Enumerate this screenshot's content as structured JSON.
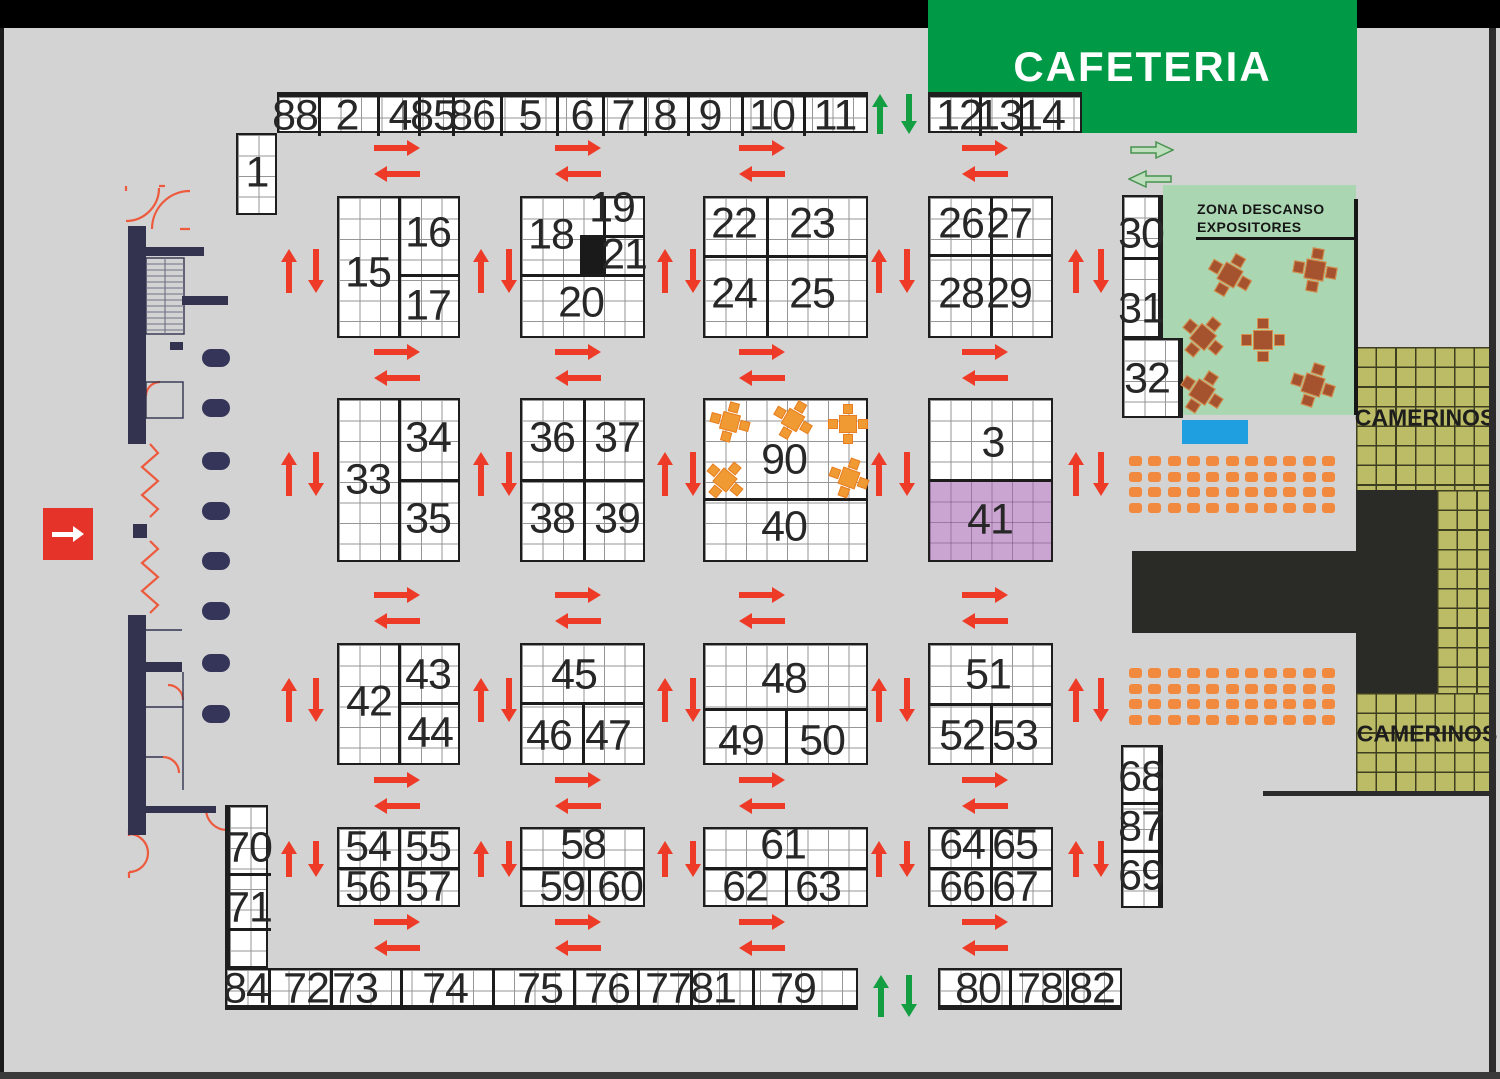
{
  "labels": {
    "cafeteria": "CAFETERIA",
    "zona_line1": "ZONA DESCANSO",
    "zona_line2": "EXPOSITORES",
    "camerinos_top": "CAMERINOS",
    "camerinos_bottom": "CAMERINOS"
  },
  "colors": {
    "background": "#d3d3d3",
    "cafeteria_green": "#009a47",
    "rest_zone_green": "#aad6b1",
    "camerinos_olive": "#bcbb66",
    "booth_white": "#ffffff",
    "grid_line": "#969696",
    "border_black": "#1c1c1c",
    "arrow_red": "#ee3b27",
    "arrow_green": "#149e42",
    "arrow_light_green": "#bedebe",
    "seat_orange": "#f18a3e",
    "table_brown": "#a5532f",
    "table_orange": "#f09a33",
    "booth41_purple": "#cba5d2",
    "stage_black": "#2a2a26",
    "wall_navy": "#33334f",
    "blue_marker": "#1f9fe0",
    "entrance_red": "#e5332a"
  },
  "booth_grids": [
    {
      "name": "strip-top-left",
      "x": 277,
      "y": 92,
      "w": 591,
      "h": 41,
      "thick": "top",
      "vdivs": [
        318,
        377,
        418,
        452,
        500,
        556,
        602,
        644,
        687,
        741,
        803
      ],
      "labels": [
        [
          "88",
          295,
          113
        ],
        [
          "2",
          347,
          113
        ],
        [
          "4",
          400,
          113
        ],
        [
          "85",
          433,
          113
        ],
        [
          "86",
          472,
          113
        ],
        [
          "5",
          530,
          113
        ],
        [
          "6",
          582,
          113
        ],
        [
          "7",
          623,
          113
        ],
        [
          "8",
          665,
          113
        ],
        [
          "9",
          710,
          113
        ],
        [
          "10",
          772,
          113
        ],
        [
          "11",
          835,
          113
        ]
      ]
    },
    {
      "name": "strip-top-right",
      "x": 928,
      "y": 92,
      "w": 154,
      "h": 41,
      "thick": "top",
      "vdivs": [
        979,
        1020
      ],
      "labels": [
        [
          "12",
          959,
          113
        ],
        [
          "13",
          999,
          113
        ],
        [
          "14",
          1042,
          113
        ]
      ]
    },
    {
      "name": "booth-1",
      "x": 236,
      "y": 133,
      "w": 41,
      "h": 82,
      "labels": [
        [
          "1",
          257,
          173
        ]
      ]
    },
    {
      "name": "block-15-16-17",
      "x": 337,
      "y": 196,
      "w": 123,
      "h": 142,
      "vdivs": [
        [
          398,
          196,
          338
        ]
      ],
      "hdivs": [
        [
          274,
          398,
          460
        ]
      ],
      "labels": [
        [
          "15",
          368,
          273
        ],
        [
          "16",
          428,
          233
        ],
        [
          "17",
          428,
          306
        ]
      ]
    },
    {
      "name": "block-18-19-20-21",
      "x": 520,
      "y": 196,
      "w": 125,
      "h": 142,
      "vdivs": [
        [
          603,
          196,
          274
        ]
      ],
      "hdivs": [
        [
          235,
          580,
          645
        ],
        [
          274,
          520,
          645
        ]
      ],
      "fills": [
        [
          580,
          235,
          23,
          39,
          "cell-black"
        ]
      ],
      "labels": [
        [
          "18",
          551,
          235
        ],
        [
          "19",
          612,
          208
        ],
        [
          "21",
          624,
          255
        ],
        [
          "20",
          581,
          303
        ]
      ]
    },
    {
      "name": "block-22-23-24-25",
      "x": 703,
      "y": 196,
      "w": 165,
      "h": 142,
      "vdivs": [
        [
          766,
          196,
          338
        ]
      ],
      "hdivs": [
        [
          255,
          703,
          868
        ]
      ],
      "labels": [
        [
          "22",
          734,
          224
        ],
        [
          "23",
          812,
          224
        ],
        [
          "24",
          734,
          294
        ],
        [
          "25",
          812,
          294
        ]
      ]
    },
    {
      "name": "block-26-27-28-29",
      "x": 928,
      "y": 196,
      "w": 125,
      "h": 142,
      "vdivs": [
        [
          990,
          196,
          338
        ]
      ],
      "hdivs": [
        [
          254,
          928,
          1053
        ]
      ],
      "labels": [
        [
          "26",
          961,
          224
        ],
        [
          "27",
          1009,
          224
        ],
        [
          "28",
          961,
          294
        ],
        [
          "29",
          1009,
          294
        ]
      ]
    },
    {
      "name": "strip-30-31",
      "x": 1122,
      "y": 195,
      "w": 41,
      "h": 143,
      "thick": "right",
      "hdivs": [
        [
          257,
          1122,
          1163
        ]
      ],
      "labels": [
        [
          "30",
          1141,
          234
        ],
        [
          "31",
          1141,
          309
        ]
      ]
    },
    {
      "name": "booth-32",
      "x": 1122,
      "y": 338,
      "w": 61,
      "h": 80,
      "thick": "right",
      "labels": [
        [
          "32",
          1147,
          379
        ]
      ]
    },
    {
      "name": "block-33-34-35",
      "x": 337,
      "y": 398,
      "w": 123,
      "h": 164,
      "vdivs": [
        [
          398,
          398,
          562
        ]
      ],
      "hdivs": [
        [
          479,
          398,
          460
        ]
      ],
      "labels": [
        [
          "33",
          368,
          480
        ],
        [
          "34",
          428,
          438
        ],
        [
          "35",
          428,
          519
        ]
      ]
    },
    {
      "name": "block-36-37-38-39",
      "x": 520,
      "y": 398,
      "w": 125,
      "h": 164,
      "vdivs": [
        [
          583,
          398,
          562
        ]
      ],
      "hdivs": [
        [
          479,
          520,
          645
        ]
      ],
      "labels": [
        [
          "36",
          552,
          438
        ],
        [
          "37",
          617,
          438
        ],
        [
          "38",
          552,
          519
        ],
        [
          "39",
          617,
          519
        ]
      ]
    },
    {
      "name": "block-90-40",
      "x": 703,
      "y": 398,
      "w": 165,
      "h": 164,
      "hdivs": [
        [
          498,
          703,
          868
        ]
      ],
      "labels": [
        [
          "90",
          784,
          460
        ],
        [
          "40",
          784,
          527
        ]
      ]
    },
    {
      "name": "block-3-41",
      "x": 928,
      "y": 398,
      "w": 125,
      "h": 164,
      "hdivs": [
        [
          479,
          928,
          1053
        ]
      ],
      "fills": [
        [
          930,
          481,
          121,
          79,
          "cell-purple"
        ]
      ],
      "labels": [
        [
          "3",
          993,
          443
        ],
        [
          "41",
          990,
          520
        ]
      ]
    },
    {
      "name": "block-42-43-44",
      "x": 337,
      "y": 643,
      "w": 123,
      "h": 122,
      "vdivs": [
        [
          398,
          643,
          765
        ]
      ],
      "hdivs": [
        [
          702,
          398,
          460
        ]
      ],
      "labels": [
        [
          "42",
          369,
          702
        ],
        [
          "43",
          428,
          675
        ],
        [
          "44",
          430,
          733
        ]
      ]
    },
    {
      "name": "block-45-46-47",
      "x": 520,
      "y": 643,
      "w": 125,
      "h": 122,
      "vdivs": [
        [
          582,
          702,
          765
        ]
      ],
      "hdivs": [
        [
          702,
          520,
          645
        ]
      ],
      "labels": [
        [
          "45",
          574,
          675
        ],
        [
          "46",
          549,
          736
        ],
        [
          "47",
          608,
          736
        ]
      ]
    },
    {
      "name": "block-48-49-50",
      "x": 703,
      "y": 643,
      "w": 165,
      "h": 122,
      "vdivs": [
        [
          785,
          708,
          765
        ]
      ],
      "hdivs": [
        [
          708,
          703,
          868
        ]
      ],
      "labels": [
        [
          "48",
          784,
          679
        ],
        [
          "49",
          741,
          741
        ],
        [
          "50",
          822,
          741
        ]
      ]
    },
    {
      "name": "block-51-52-53",
      "x": 928,
      "y": 643,
      "w": 125,
      "h": 122,
      "vdivs": [
        [
          990,
          703,
          765
        ]
      ],
      "hdivs": [
        [
          703,
          928,
          1053
        ]
      ],
      "labels": [
        [
          "51",
          988,
          675
        ],
        [
          "52",
          962,
          736
        ],
        [
          "53",
          1015,
          736
        ]
      ]
    },
    {
      "name": "block-54-55-56-57",
      "x": 337,
      "y": 827,
      "w": 123,
      "h": 80,
      "vdivs": [
        [
          398,
          827,
          907
        ]
      ],
      "hdivs": [
        [
          867,
          337,
          460
        ]
      ],
      "labels": [
        [
          "54",
          368,
          847
        ],
        [
          "55",
          428,
          847
        ],
        [
          "56",
          368,
          887
        ],
        [
          "57",
          428,
          887
        ]
      ]
    },
    {
      "name": "block-58-59-60",
      "x": 520,
      "y": 827,
      "w": 125,
      "h": 80,
      "vdivs": [
        [
          588,
          867,
          907
        ]
      ],
      "hdivs": [
        [
          867,
          520,
          645
        ]
      ],
      "labels": [
        [
          "58",
          583,
          845
        ],
        [
          "59",
          562,
          887
        ],
        [
          "60",
          620,
          887
        ]
      ]
    },
    {
      "name": "block-61-62-63",
      "x": 703,
      "y": 827,
      "w": 165,
      "h": 80,
      "vdivs": [
        [
          785,
          867,
          907
        ]
      ],
      "hdivs": [
        [
          867,
          703,
          868
        ]
      ],
      "labels": [
        [
          "61",
          783,
          845
        ],
        [
          "62",
          745,
          887
        ],
        [
          "63",
          818,
          887
        ]
      ]
    },
    {
      "name": "block-64-65-66-67",
      "x": 928,
      "y": 827,
      "w": 125,
      "h": 80,
      "vdivs": [
        [
          990,
          827,
          907
        ]
      ],
      "hdivs": [
        [
          867,
          928,
          1053
        ]
      ],
      "labels": [
        [
          "64",
          962,
          845
        ],
        [
          "65",
          1015,
          845
        ],
        [
          "66",
          962,
          887
        ],
        [
          "67",
          1015,
          887
        ]
      ]
    },
    {
      "name": "strip-70-71",
      "x": 225,
      "y": 805,
      "w": 43,
      "h": 163,
      "thick": "left",
      "hdivs": [
        [
          873,
          225,
          268
        ],
        [
          928,
          225,
          268
        ]
      ],
      "labels": [
        [
          "70",
          246,
          848
        ],
        [
          "71",
          246,
          908
        ]
      ]
    },
    {
      "name": "strip-68-87-69",
      "x": 1121,
      "y": 745,
      "w": 42,
      "h": 163,
      "thick": "right",
      "hdivs": [
        [
          802,
          1121,
          1163
        ],
        [
          850,
          1121,
          1163
        ]
      ],
      "labels": [
        [
          "68",
          1141,
          777
        ],
        [
          "87",
          1141,
          827
        ],
        [
          "69",
          1141,
          876
        ]
      ]
    },
    {
      "name": "strip-bottom-left",
      "x": 225,
      "y": 968,
      "w": 633,
      "h": 42,
      "thick": "bottom",
      "vdivs": [
        268,
        330,
        400,
        492,
        573,
        637,
        690,
        752
      ],
      "labels": [
        [
          "84",
          246,
          989
        ],
        [
          "72",
          306,
          989
        ],
        [
          "73",
          355,
          989
        ],
        [
          "74",
          445,
          989
        ],
        [
          "75",
          540,
          989
        ],
        [
          "76",
          607,
          989
        ],
        [
          "77",
          668,
          989
        ],
        [
          "81",
          713,
          989
        ],
        [
          "79",
          793,
          989
        ]
      ]
    },
    {
      "name": "strip-bottom-right",
      "x": 938,
      "y": 968,
      "w": 184,
      "h": 42,
      "thick": "bottom",
      "vdivs": [
        1009,
        1066
      ],
      "labels": [
        [
          "80",
          978,
          989
        ],
        [
          "78",
          1040,
          989
        ],
        [
          "82",
          1092,
          989
        ]
      ]
    }
  ],
  "arrows": {
    "red": "#ee3b27",
    "green": "#149e42",
    "h_xs": [
      397,
      578,
      762,
      985
    ],
    "h_rows": [
      [
        148,
        174
      ],
      [
        352,
        378
      ],
      [
        595,
        621
      ],
      [
        780,
        806
      ],
      [
        922,
        948
      ]
    ],
    "h_len": 46,
    "v_pairs": [
      [
        289,
        316
      ],
      [
        481,
        509
      ],
      [
        665,
        693
      ],
      [
        879,
        907
      ],
      [
        1076,
        1101
      ]
    ],
    "v_rows": [
      271,
      474,
      700,
      859
    ],
    "v_lens": [
      44,
      44,
      44,
      36
    ],
    "green_pairs": [
      {
        "up": 880,
        "down": 909,
        "cy": 114,
        "len": 40
      },
      {
        "up": 881,
        "down": 909,
        "cy": 996,
        "len": 42
      }
    ]
  },
  "seats": {
    "color": "#f18a3e",
    "cols": 11,
    "rows": 4,
    "pw": 19.3,
    "ph": 15.7,
    "w": 13,
    "h": 10,
    "groups": [
      {
        "x": 1129,
        "y": 456
      },
      {
        "x": 1129,
        "y": 668
      }
    ]
  },
  "tables": {
    "zona": {
      "fill": "#a5532f",
      "edge": "#d88e4c",
      "size": 44,
      "pos": [
        [
          1230,
          275,
          30
        ],
        [
          1315,
          270,
          10
        ],
        [
          1203,
          337,
          40
        ],
        [
          1263,
          340,
          0
        ],
        [
          1202,
          392,
          33
        ],
        [
          1313,
          385,
          18
        ]
      ]
    },
    "booth90": {
      "fill": "#f09a33",
      "edge": "#e87f22",
      "size": 40,
      "pos": [
        [
          730,
          422,
          15
        ],
        [
          793,
          420,
          30
        ],
        [
          848,
          424,
          0
        ],
        [
          725,
          480,
          40
        ],
        [
          849,
          478,
          20
        ]
      ]
    }
  },
  "columns": {
    "x": 202,
    "w": 28,
    "h": 18,
    "ys": [
      358,
      408,
      461,
      511,
      561,
      611,
      663,
      714
    ]
  },
  "walls": [
    [
      128,
      226,
      18,
      218
    ],
    [
      146,
      247,
      58,
      9
    ],
    [
      182,
      296,
      46,
      9
    ],
    [
      170,
      342,
      13,
      8
    ],
    [
      128,
      615,
      18,
      220
    ],
    [
      146,
      662,
      36,
      10
    ],
    [
      133,
      524,
      14,
      14
    ],
    [
      146,
      806,
      70,
      7
    ]
  ],
  "entrance": {
    "x": 43,
    "y": 508,
    "w": 50,
    "h": 52
  }
}
